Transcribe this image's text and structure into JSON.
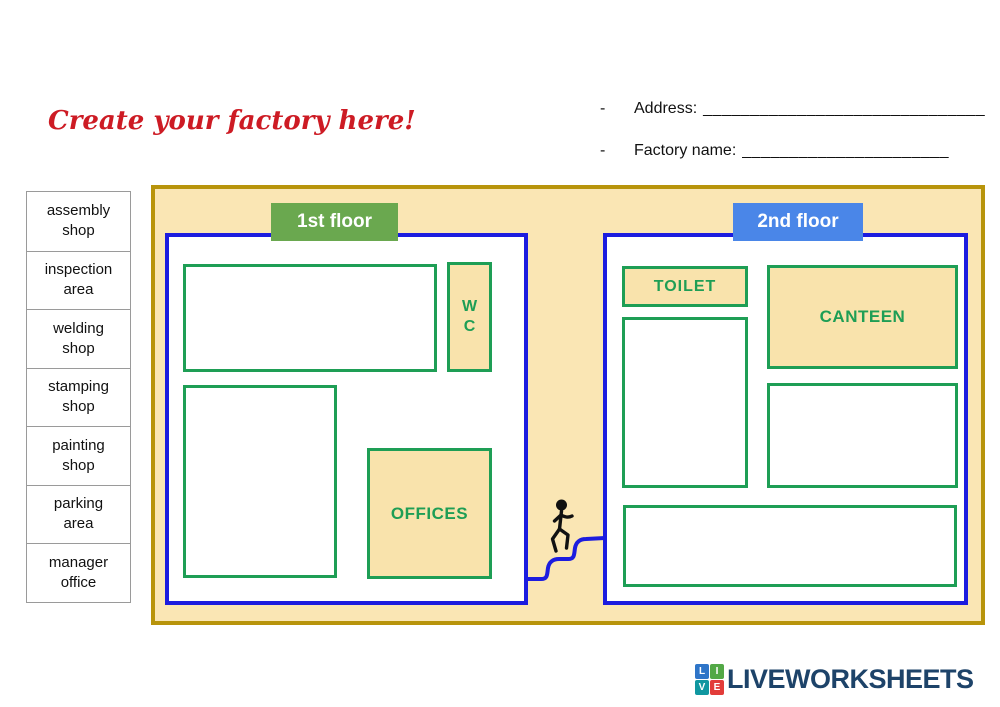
{
  "title": {
    "text": "Create your factory here!"
  },
  "form": {
    "rows": [
      {
        "bullet": "-",
        "label": "Address:",
        "blank": "______________________________"
      },
      {
        "bullet": "-",
        "label": "Factory name:",
        "blank": "______________________"
      }
    ]
  },
  "word_bank": {
    "items": [
      "assembly\nshop",
      "inspection\narea",
      "welding\nshop",
      "stamping\nshop",
      "painting\nshop",
      "parking\narea",
      "manager\noffice"
    ]
  },
  "plan": {
    "floor1": {
      "header": "1st floor",
      "wc_label": "W\nC",
      "offices_label": "OFFICES"
    },
    "floor2": {
      "header": "2nd floor",
      "toilet_label": "TOILET",
      "canteen_label": "CANTEEN"
    }
  },
  "footer": {
    "brand": "LIVEWORKSHEETS",
    "tiles": [
      {
        "letter": "L",
        "color": "#2E75C8"
      },
      {
        "letter": "I",
        "color": "#52A846"
      },
      {
        "letter": "V",
        "color": "#1097A0"
      },
      {
        "letter": "E",
        "color": "#E23C39"
      }
    ]
  },
  "colors": {
    "title_red": "#CD1B24",
    "canvas_bg": "#FAE6B4",
    "room_fill": "#F9E3AC",
    "outer_border": "#B8940B",
    "floor_border": "#1C1CDF",
    "room_border": "#1E9E55",
    "floor1_header_bg": "#6AA84F",
    "floor2_header_bg": "#4A86E8",
    "brand_navy": "#1D4369"
  }
}
